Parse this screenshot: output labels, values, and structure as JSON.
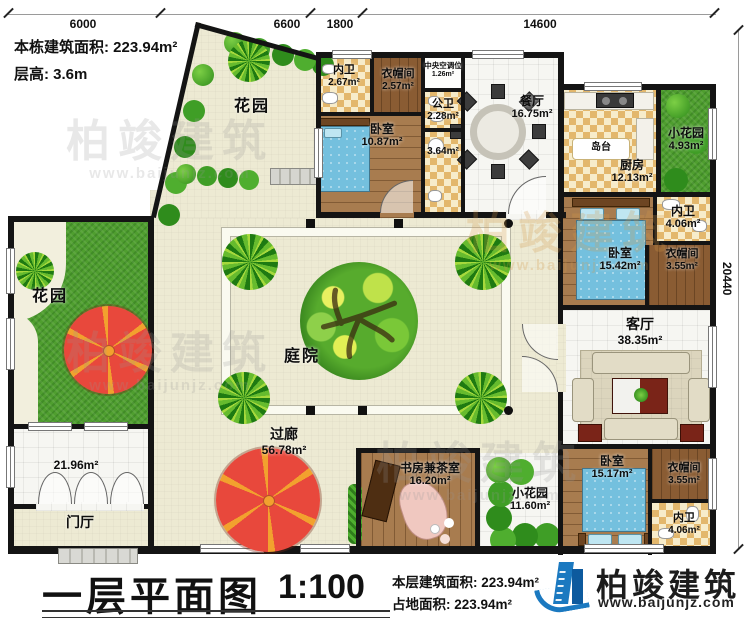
{
  "header": {
    "building_area": "本栋建筑面积: 223.94m²",
    "floor_height": "层高: 3.6m"
  },
  "dimensions": {
    "top1": "6000",
    "top2": "6600",
    "top3": "1800",
    "top4": "14600",
    "right": "20440"
  },
  "rooms": {
    "garden_tl": {
      "label": "花园"
    },
    "neiwei_top": {
      "label": "内卫",
      "area": "2.67m²"
    },
    "yimao_top": {
      "label": "衣帽间",
      "area": "2.57m²"
    },
    "hvac": {
      "label": "中央空调位",
      "area": "1.26m²"
    },
    "bedroom_top": {
      "label": "卧室",
      "area": "10.87m²"
    },
    "gongwei": {
      "label": "公卫",
      "area": "2.28m²"
    },
    "hall364": {
      "area": "3.64m²"
    },
    "dining": {
      "label": "餐厅",
      "area": "16.75m²"
    },
    "island": {
      "label": "岛台"
    },
    "kitchen": {
      "label": "厨房",
      "area": "12.13m²"
    },
    "small_garden_top": {
      "label": "小花园",
      "area": "4.93m²"
    },
    "neiwei_right": {
      "label": "内卫",
      "area": "4.06m²"
    },
    "bedroom_right": {
      "label": "卧室",
      "area": "15.42m²"
    },
    "yimao_right": {
      "label": "衣帽间",
      "area": "3.55m²"
    },
    "living": {
      "label": "客厅",
      "area": "38.35m²"
    },
    "bedroom_bottom": {
      "label": "卧室",
      "area": "15.17m²"
    },
    "yimao_bottom": {
      "label": "衣帽间",
      "area": "3.55m²"
    },
    "neiwei_bottom": {
      "label": "内卫",
      "area": "4.06m²"
    },
    "study": {
      "label": "书房兼茶室",
      "area": "16.20m²"
    },
    "small_garden_bottom": {
      "label": "小花园",
      "area": "11.60m²"
    },
    "courtyard": {
      "label": "庭院"
    },
    "corridor": {
      "label": "过廊",
      "area": "56.78m²"
    },
    "garden_left": {
      "label": "花园"
    },
    "terrace": {
      "area": "21.96m²"
    },
    "foyer": {
      "label": "门厅"
    }
  },
  "footer": {
    "plan_title": "一层平面图",
    "scale": "1:100",
    "floor_area": "本层建筑面积: 223.94m²",
    "land_area": "占地面积: 223.94m²",
    "brand": "柏竣建筑",
    "website": "www.baijunjz.com"
  },
  "watermark": {
    "brand": "柏竣建筑",
    "site": "www.baijunjz.com"
  }
}
